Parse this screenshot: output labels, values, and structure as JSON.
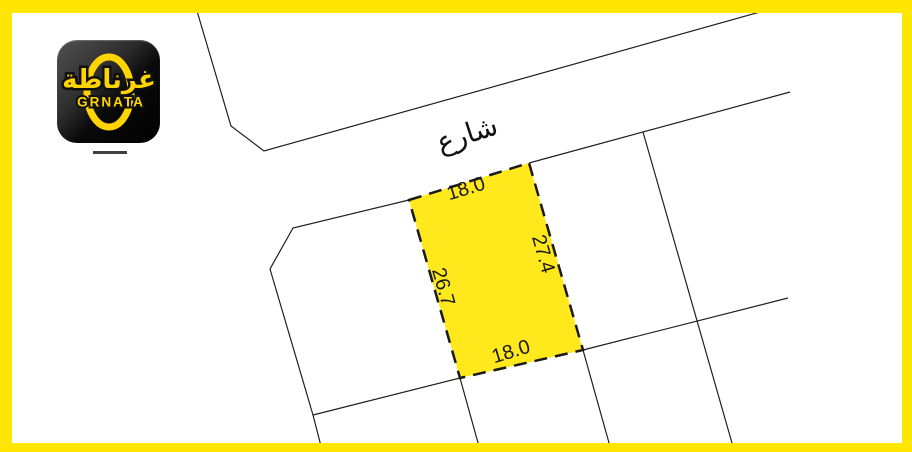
{
  "colors": {
    "frame_yellow": "#FFE600",
    "plot_fill": "#FFE81C",
    "line_color": "#1F1F1F",
    "logo_yellow": "#FFD400"
  },
  "logo": {
    "arabic_name": "غرناطة",
    "latin_name": "GRNATA"
  },
  "map": {
    "street_label": "شارع",
    "plot": {
      "top_dim": "18.0",
      "right_dim": "27.4",
      "left_dim": "26.7",
      "bottom_dim": "18.0"
    }
  }
}
